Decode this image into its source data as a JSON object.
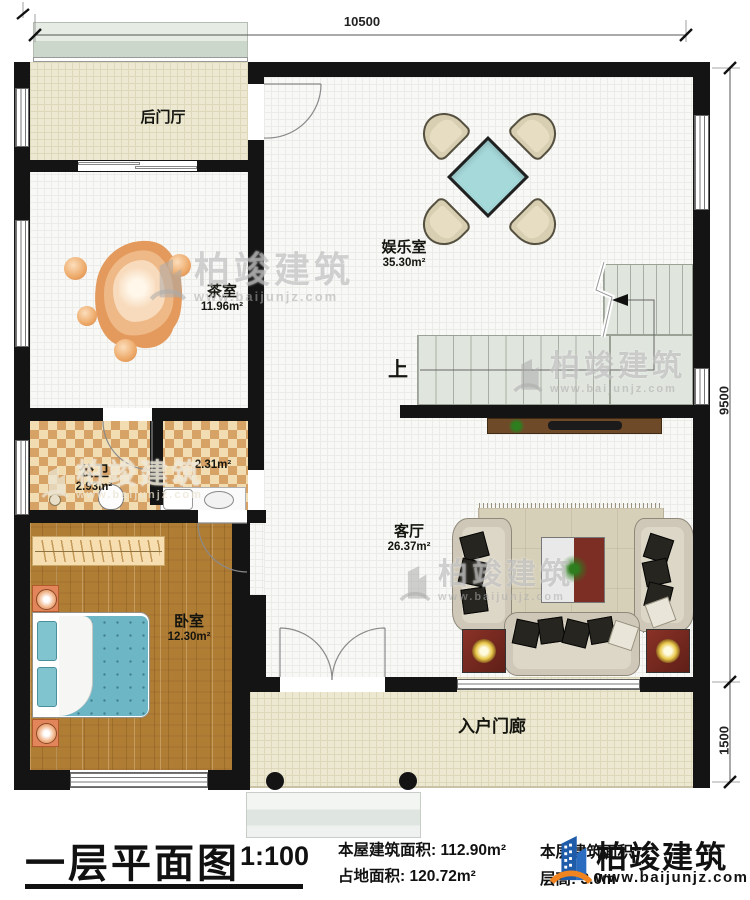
{
  "dimensions": {
    "top": "10500",
    "right_upper": "9500",
    "right_lower": "1500"
  },
  "rooms": {
    "back_hall": {
      "name": "后门厅"
    },
    "tea_room": {
      "name": "茶室",
      "area": "11.96m²"
    },
    "entertainment": {
      "name": "娱乐室",
      "area": "35.30m²"
    },
    "bathroom": {
      "name": "公卫",
      "area": "2.93m²"
    },
    "utility": {
      "area": "2.31m²"
    },
    "bedroom": {
      "name": "卧室",
      "area": "12.30m²"
    },
    "living_room": {
      "name": "客厅",
      "area": "26.37m²"
    },
    "porch": {
      "name": "入户门廊"
    },
    "stairs": {
      "up": "上"
    }
  },
  "title_block": {
    "title": "一层平面图",
    "scale": "1:100",
    "house_area_label": "本屋建筑面积:",
    "house_area_value": "112.90m²",
    "land_area_label": "占地面积:",
    "land_area_value": "120.72m²",
    "floor_area_label": "本层建筑面积:",
    "floor_height_label": "层高:",
    "floor_height_value": "3.0m"
  },
  "watermark": {
    "brand": "柏竣建筑",
    "url": "www.baijunjz.com"
  },
  "logo": {
    "brand": "柏竣建筑",
    "url": "www.baijunjz.com"
  },
  "colors": {
    "wall": "#141414",
    "table_teal": "#a6d9da",
    "wood": "#b07d35",
    "logo_blue": "#1e5caa",
    "logo_orange": "#f08420"
  }
}
